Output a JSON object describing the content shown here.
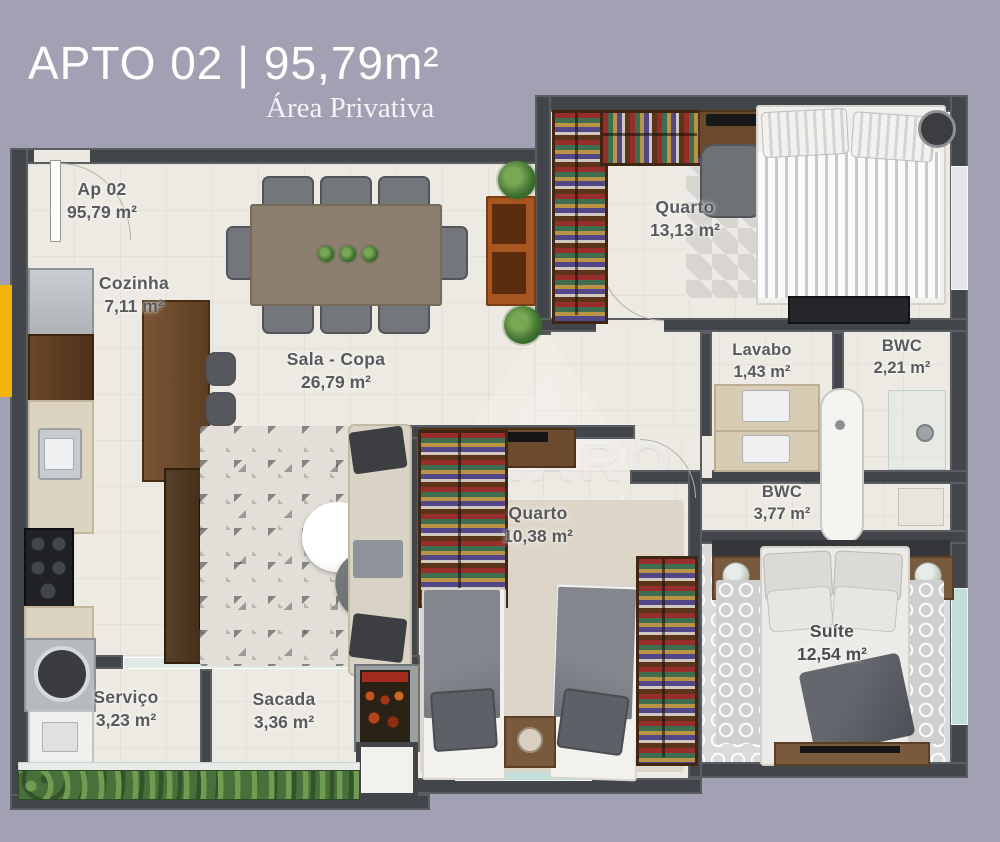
{
  "header": {
    "title": "APTO 02 | 95,79m²",
    "subtitle": "Área Privativa"
  },
  "watermark": {
    "name": "TAVERNARO",
    "tagline": "CONSULTORIA IMOBILIÁRIA"
  },
  "rooms": [
    {
      "id": "entry",
      "name": "Ap 02",
      "area": "95,79 m²"
    },
    {
      "id": "cozinha",
      "name": "Cozinha",
      "area": "7,11 m²"
    },
    {
      "id": "sala",
      "name": "Sala - Copa",
      "area": "26,79 m²"
    },
    {
      "id": "quarto1",
      "name": "Quarto",
      "area": "13,13 m²"
    },
    {
      "id": "lavabo",
      "name": "Lavabo",
      "area": "1,43 m²"
    },
    {
      "id": "bwc_pequeno",
      "name": "BWC",
      "area": "2,21 m²"
    },
    {
      "id": "bwc_grande",
      "name": "BWC",
      "area": "3,77 m²"
    },
    {
      "id": "quarto2",
      "name": "Quarto",
      "area": "10,38 m²"
    },
    {
      "id": "suite",
      "name": "Suíte",
      "area": "12,54 m²"
    },
    {
      "id": "servico",
      "name": "Serviço",
      "area": "3,23 m²"
    },
    {
      "id": "sacada",
      "name": "Sacada",
      "area": "3,36 m²"
    }
  ],
  "colors": {
    "background": "#a1a1b3",
    "wall": "#42454a",
    "floor": "#edeae3",
    "accent_yellow": "#f0b40a",
    "plant_green": "#49703a",
    "window_teal": "#c2ded8",
    "wood": "#6b4a2e",
    "label_text": "#595a5e"
  }
}
